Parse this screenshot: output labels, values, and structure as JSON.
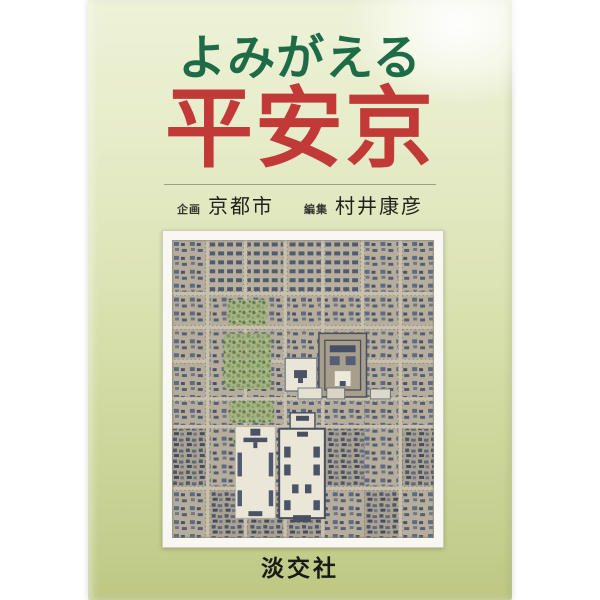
{
  "cover": {
    "title_line1": "よみがえる",
    "title_line2": "平安京",
    "credits": [
      {
        "role": "企画",
        "name": "京都市"
      },
      {
        "role": "編集",
        "name": "村井康彦"
      }
    ],
    "publisher": "淡交社",
    "photo": {
      "subject": "平安京復元模型の空撮写真"
    },
    "colors": {
      "title_kana_green": "#1e6b47",
      "title_kanji_red": "#c23a38",
      "cover_gradient_top": "#eef2d8",
      "cover_gradient_bottom": "#bec883",
      "photo_ground_tan": "#c8c0ab",
      "photo_building_blue": "#5d6a85",
      "photo_tree_green": "#a3b383"
    }
  }
}
